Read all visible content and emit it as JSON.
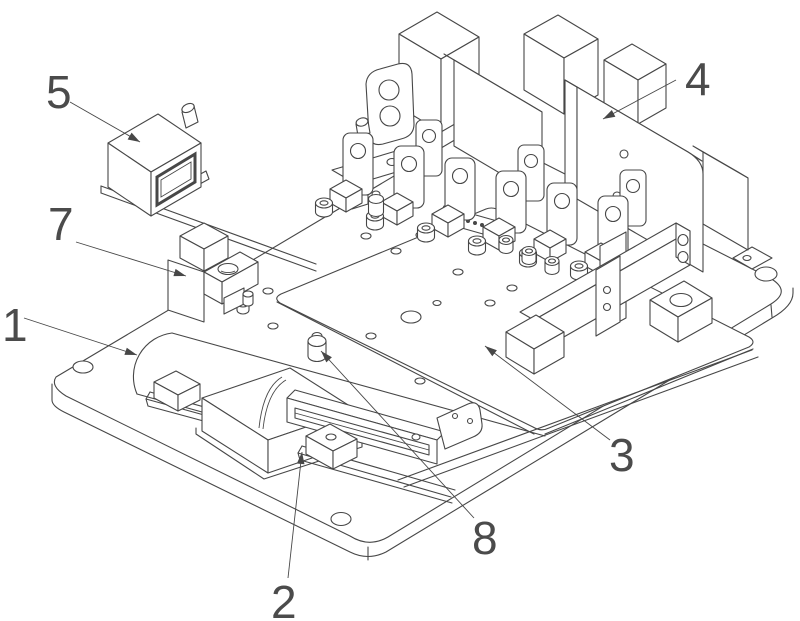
{
  "figure": {
    "background_color": "#ffffff",
    "line_color": "#474747",
    "label_color": "#4b4b4b"
  },
  "callouts": [
    {
      "label": "1"
    },
    {
      "label": "2"
    },
    {
      "label": "3"
    },
    {
      "label": "4"
    },
    {
      "label": "5"
    },
    {
      "label": "7"
    },
    {
      "label": "8"
    }
  ]
}
